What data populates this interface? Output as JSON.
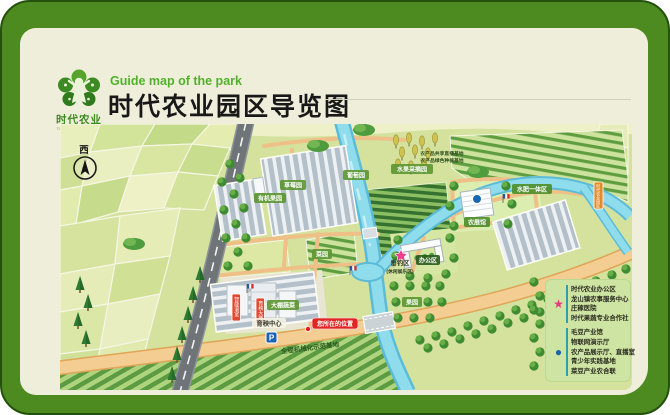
{
  "header": {
    "logo_title": "时代农业",
    "logo_subtitle": "TIME AGRICULTURE",
    "subtitle": "Guide map of the park",
    "title": "时代农业园区导览图"
  },
  "map": {
    "compass": "西",
    "labels": {
      "fruit_picking": "水果采摘园",
      "note_line1": "农产品共享直播基地",
      "note_line2": "农产品绿色种植基地",
      "grape": "葡萄园",
      "strawberry": "草莓园",
      "organic_orchard": "有机果园",
      "veg_garden": "菜园",
      "greenhouse_veg": "大棚蔬菜",
      "orchard": "果园",
      "agri_hall": "农展馆",
      "fertigation": "水肥一体区",
      "office": "办公区",
      "fishing": "垂钓区",
      "fishing_sub": "(休闲娱乐区)",
      "seedling_center": "育秧中心",
      "you_are_here": "您所在的位置",
      "mechanization": "全程机械化示范基地",
      "smart_greenhouse": "智能温室",
      "nursery_greenhouse": "育秧大棚",
      "gate": "时代农业园区",
      "parking": "P"
    }
  },
  "legend": {
    "star": {
      "symbol": "★",
      "color": "#e6397e",
      "items": [
        "时代农业办公区",
        "龙山镇农事服务中心",
        "庄稼医院",
        "时代果蔬专业合作社"
      ]
    },
    "dot": {
      "symbol": "●",
      "color": "#1565b0",
      "items": [
        "毛豆产业馆",
        "物联网演示厅",
        "农产品展示厅、直播室",
        "青少年实践基地",
        "菜豆产业农合联"
      ]
    }
  },
  "colors": {
    "frame_green": "#4d8a20",
    "panel_cream": "#efeedb",
    "accent_green": "#53b02c",
    "star_pink": "#e6397e",
    "dot_blue": "#1565b0"
  }
}
